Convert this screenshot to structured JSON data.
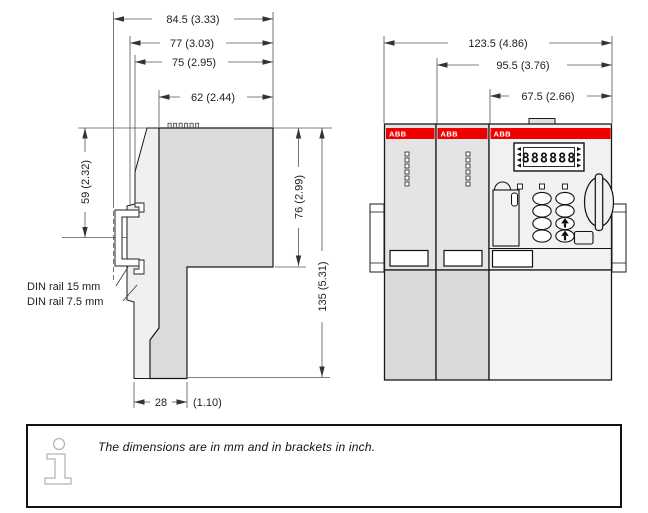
{
  "side": {
    "dims": {
      "d84_5": "84.5 (3.33)",
      "d77": "77 (3.03)",
      "d75": "75 (2.95)",
      "d62": "62 (2.44)",
      "d59": "59 (2.32)",
      "d76": "76 (2.99)",
      "d135": "135 (5.31)",
      "d28_mm": "28",
      "d28_inch": "(1.10)"
    },
    "labels": {
      "din15": "DIN rail 15 mm",
      "din75": "DIN rail 7.5 mm"
    }
  },
  "front": {
    "dims": {
      "d123_5": "123.5 (4.86)",
      "d95_5": "95.5 (3.76)",
      "d67_5": "67.5 (2.66)"
    },
    "brand": "ABB",
    "display": "888888",
    "brand_color": "#ee0000"
  },
  "note": {
    "text": "The dimensions are in mm and in brackets in inch."
  }
}
